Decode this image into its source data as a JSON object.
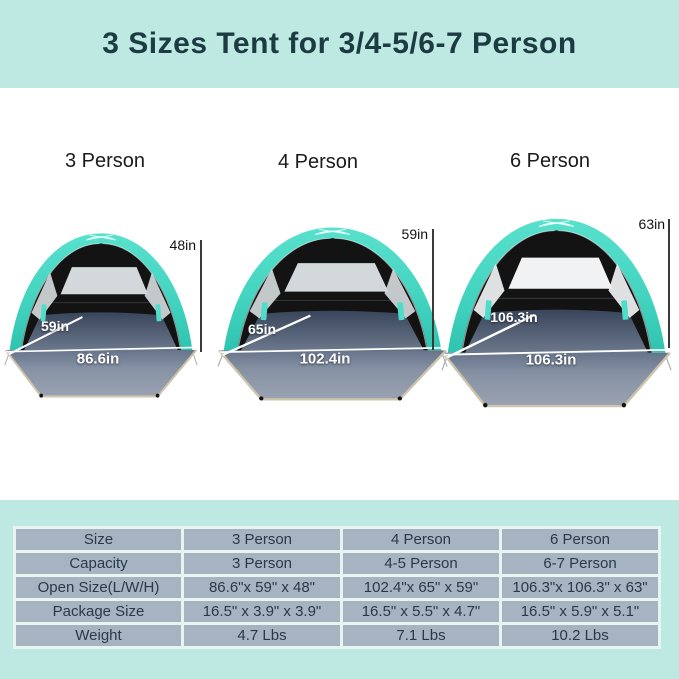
{
  "header": {
    "title": "3 Sizes Tent for 3/4-5/6-7 Person"
  },
  "tents": [
    {
      "name": "3 Person",
      "height": "48in",
      "depth": "59in",
      "width": "86.6in"
    },
    {
      "name": "4 Person",
      "height": "59in",
      "depth": "65in",
      "width": "102.4in"
    },
    {
      "name": "6 Person",
      "height": "63in",
      "depth": "106.3in",
      "width": "106.3in"
    }
  ],
  "spec_table": {
    "rows": [
      {
        "label": "Size",
        "values": [
          "3 Person",
          "4 Person",
          "6 Person"
        ]
      },
      {
        "label": "Capacity",
        "values": [
          "3 Person",
          "4-5 Person",
          "6-7 Person"
        ]
      },
      {
        "label": "Open Size(L/W/H)",
        "values": [
          "86.6\"x 59\" x 48\"",
          "102.4\"x 65\" x 59\"",
          "106.3\"x 106.3\" x 63\""
        ]
      },
      {
        "label": "Package Size",
        "values": [
          "16.5\" x 3.9\" x 3.9\"",
          "16.5\" x 5.5\" x 4.7\"",
          "16.5\" x 5.9\" x 5.1\""
        ]
      },
      {
        "label": "Weight",
        "values": [
          "4.7 Lbs",
          "7.1 Lbs",
          "10.2 Lbs"
        ]
      }
    ]
  },
  "colors": {
    "banner_background": "#bee8e2",
    "banner_text": "#1d3b43",
    "tent_canopy_teal": "#4bdac6",
    "tent_interior_black": "#131313",
    "tent_floor_gray": "#8793a5",
    "floor_trim_beige": "#cdc4ab",
    "table_cell": "#a6b4c1",
    "table_text": "#2a3849",
    "measure_text_white": "#ffffff",
    "measure_text_black": "#111111"
  }
}
